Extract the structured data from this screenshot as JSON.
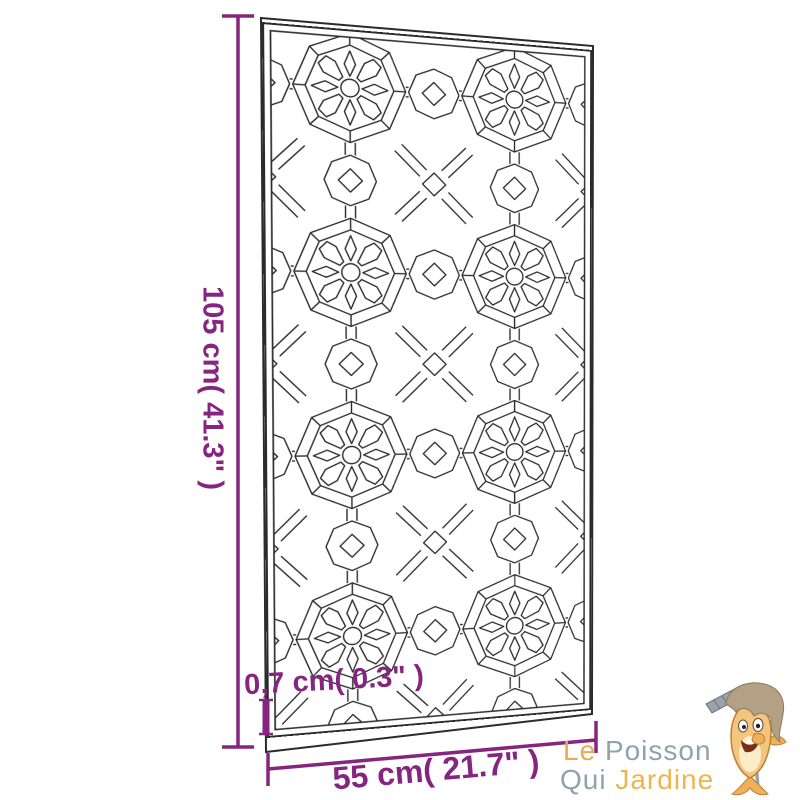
{
  "dimensions": {
    "height_label": "105 cm( 41.3\" )",
    "width_label": "55 cm( 21.7\" )",
    "thickness_label": "0,7 cm( 0.3\" )",
    "height_cm": 105,
    "height_in": 41.3,
    "width_cm": 55,
    "width_in": 21.7,
    "thickness_cm": 0.7,
    "thickness_in": 0.3
  },
  "logo": {
    "word_le": "Le",
    "word_poisson": "Poisson",
    "word_qui": "Qui",
    "word_jardine": "Jardine"
  },
  "icons": {
    "mascot": "fish-gardener-mascot",
    "mascot_tool": "rake-icon"
  },
  "colors": {
    "dimension_purple": "#86257f",
    "logo_orange": "#eda94f",
    "logo_blue_gray": "#8fa3ad",
    "logo_yellow": "#edb54f",
    "pattern_line": "#2b2b2b"
  }
}
